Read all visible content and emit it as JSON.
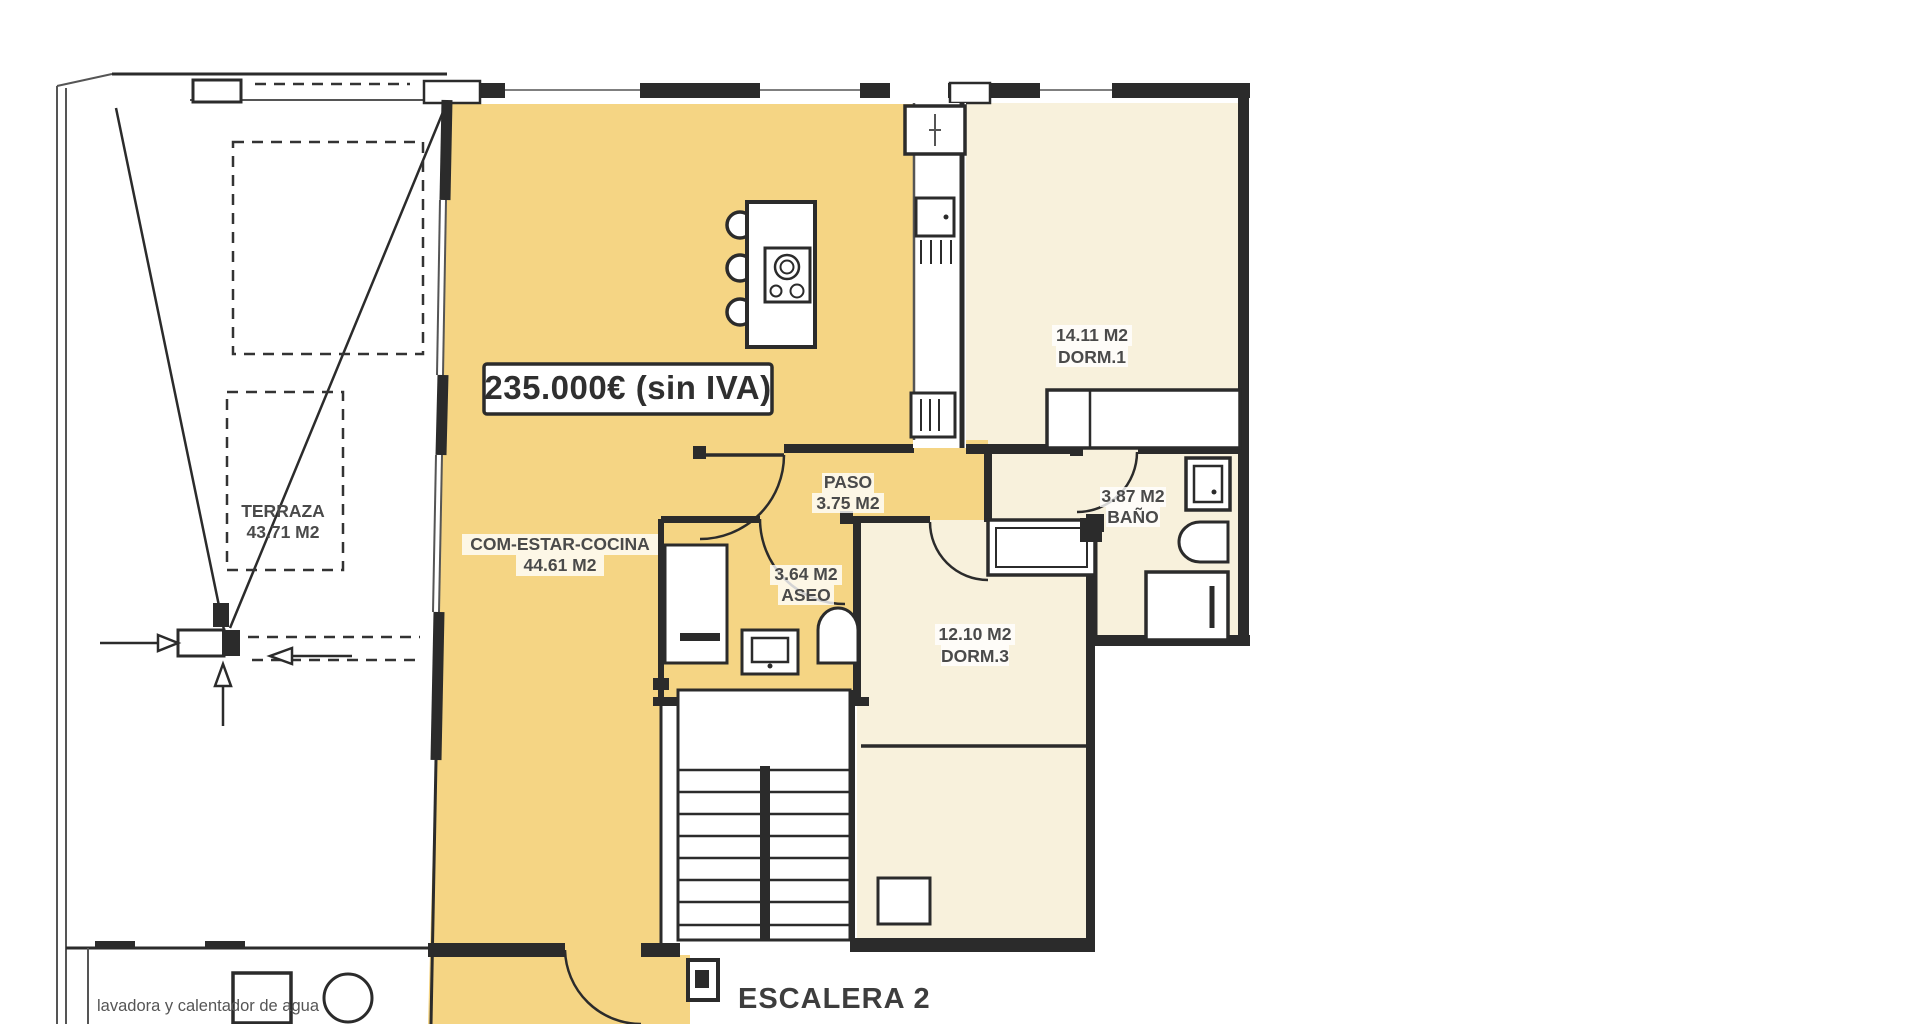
{
  "price_tag": "235.000€ (sin IVA)",
  "stairwell_label": "ESCALERA 2",
  "terrace_note": "lavadora y calentador de agua",
  "rooms": {
    "terraza": {
      "name": "TERRAZA",
      "area": "43.71 M2"
    },
    "salon": {
      "name": "COM-ESTAR-COCINA",
      "area": "44.61 M2"
    },
    "paso": {
      "name": "PASO",
      "area": "3.75 M2"
    },
    "aseo": {
      "name": "ASEO",
      "area": "3.64 M2"
    },
    "dorm1": {
      "name": "DORM.1",
      "area": "14.11 M2"
    },
    "bano": {
      "name": "BAÑO",
      "area": "3.87 M2"
    },
    "dorm3": {
      "name": "DORM.3",
      "area": "12.10 M2"
    }
  },
  "colors": {
    "living_fill": "#f5d584",
    "bedroom_fill": "#f8f1dc",
    "wall": "#2b2b2b",
    "label_text": "#4a4a4a"
  }
}
